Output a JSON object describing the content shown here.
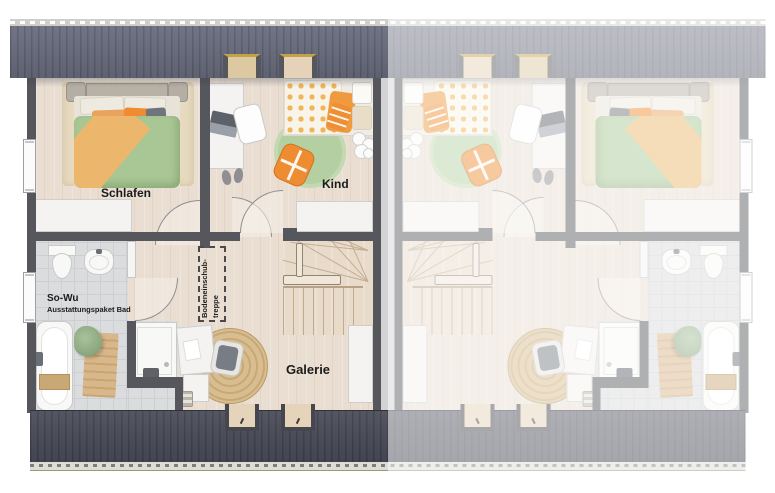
{
  "plan": {
    "rooms": {
      "bedroom_label": "Schlafen",
      "child_label": "Kind",
      "gallery_label": "Galerie"
    },
    "bath": {
      "title": "So-Wu",
      "subtitle": "Ausstattungspaket Bad"
    },
    "attic_stairs": {
      "line1": "Bodeneinschub-",
      "line2": "treppe"
    },
    "colors": {
      "roof_top": "#636678",
      "roof_bottom": "#454754",
      "wall": "#56575d",
      "floor_wood": "#e9ded1",
      "bath_tile": "#dadcde",
      "accent_orange": "#ef9a3e",
      "accent_green": "#a9c795",
      "rug_green": "#b4d0a3",
      "fade_overlay": "rgba(255,255,255,0.53)"
    }
  }
}
